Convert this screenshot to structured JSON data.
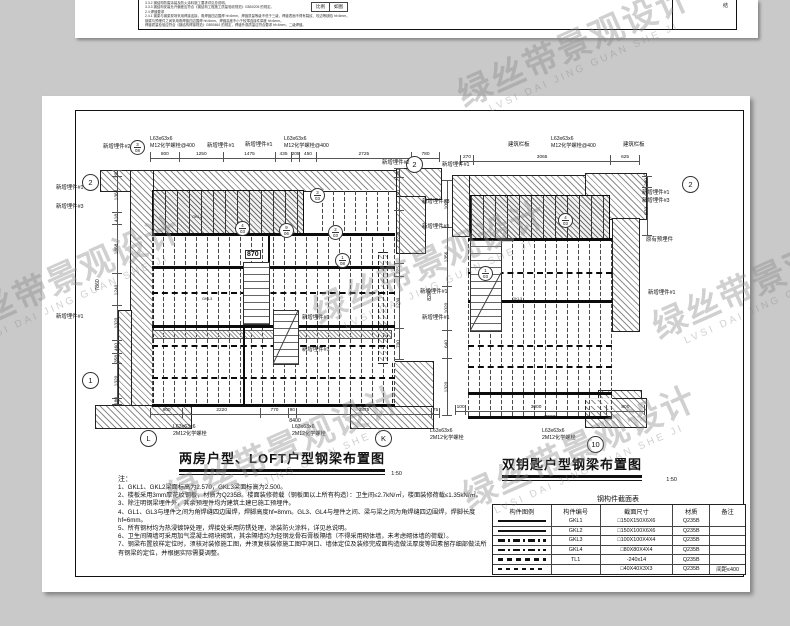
{
  "watermark": {
    "cn": "绿丝带景观设计",
    "en": "LVSI DAI JING GUAN SHE JI"
  },
  "top_sheet": {
    "lines": [
      "3.3.2 钢结构防腐涂装及防火涂料施工要求详见总说明。",
      "3.3.3 钢结构安装允许偏差应符合《钢结构工程施工质量验收规范》GB50205 的规定。",
      "2.4 焊缝要求",
      "2.4.1 钢梁与钢梁现场采用焊接连接，角焊缝四边围焊 hf=6mm，焊缝质量等级不低于三级，焊缝表面不得有裂纹、咬边等缺陷 hf=6mm。",
      "钢梁与预埋件之间采用角焊缝四边围焊 hf=6mm，焊缝高度不小于较薄连接件厚度 hf=6mm。",
      "焊缝质量检验应符合《钢结构焊接规范》GB50661 的规定，焊缝外观质量应符合要求 hf=6mm，二级焊缝。"
    ],
    "scale_label": "比例",
    "scale_value": "如图",
    "corner_mark": "结"
  },
  "plans": {
    "left": {
      "title": "两房户型、LOFT户型钢梁布置图",
      "scale": "1:50",
      "dims_top": [
        "800",
        "1250",
        "1475",
        "435",
        "205",
        "450",
        "2725",
        "780"
      ],
      "dims_bottom": [
        "900",
        "2220",
        "770",
        "90",
        "3875",
        "75"
      ],
      "total_bottom": "8400",
      "dims_left": [
        "200",
        "1368",
        "418",
        "1868",
        "1240",
        "1320",
        "460",
        "358",
        "1320",
        "180"
      ],
      "total_left": "7860",
      "dims_right": [
        "200",
        "750",
        "1229",
        "275",
        "1230",
        "700"
      ],
      "stair_width": "870"
    },
    "right": {
      "title": "双钥匙户型钢梁布置图",
      "scale": "1:50",
      "dims_top": [
        "270",
        "3065",
        "625"
      ],
      "dims_bottom": [
        "100",
        "3000",
        "800"
      ],
      "total_bottom": "3900",
      "dims_left": [
        "1090",
        "1356",
        "1020",
        "640",
        "1320"
      ],
      "total_left": "8200",
      "dims_right": [
        "200",
        "970"
      ]
    }
  },
  "labels": {
    "new_embed_1": "新增埋件#1",
    "new_embed_2": "新增埋件#2",
    "new_embed_3": "新增埋件#3",
    "orig_embed": "原有预埋件",
    "rail": "建筑栏板",
    "angle": "L63x63x6",
    "bolt400": "M12化学螺栓@400",
    "bolt2": "2M12化学螺栓"
  },
  "axes": {
    "two": "2",
    "one": "1",
    "L": "L",
    "K": "K",
    "ten": "10"
  },
  "details": {
    "d1n": "3",
    "d1s": "08",
    "d2n": "3",
    "d2s": "03",
    "d3n": "4",
    "d3s": "03",
    "d4n": "9",
    "d4s": "06",
    "d5n": "2",
    "d5s": "03",
    "d6n": "1",
    "d6s": "08",
    "d7n": "4",
    "d7s": "03",
    "d8n": "1",
    "d8s": "03"
  },
  "beam_tags": {
    "g2": "GKL2",
    "g3": "GKL3"
  },
  "notes": {
    "label": "注：",
    "lines": [
      "1、GKL1、GKL2梁面标高为2.570，GKL3梁面标高为2.500。",
      "2、楼板采用3mm厚花纹钢板，材质为Q235B。楼面装修荷载（钢板面以上所有构造）：卫生间≤2.7kN/㎡，楼面装修荷载≤1.35kN/㎡。",
      "3、除注明钢梁埋件外，其余预埋件均为建筑土建已施工预埋件。",
      "4、GL1、GL3与埋件之间为角焊缝四边围焊，焊脚高度hf=8mm。GL3、GL4与埋件之间、梁与梁之间为角焊缝四边围焊，焊脚长度hf=6mm。",
      "5、所有钢材均为热浸镀锌处理，焊接处采用防锈处理，涂装防火涂料，详见总说明。",
      "6、卫生间隔墙可采用加气混凝土砌块砌筑，其余隔墙均为轻钢龙骨石膏板隔墙（不得采用砌体墙，未考虑砌体墙的荷载）。",
      "7、钢梁布置放样定位时，须核对装修施工图，并须复核装修施工图中洞口、墙体定位及装修完成面构造做法厚度等因素留存细部做法所有钢梁的定位，并根据实际需要调整。"
    ]
  },
  "table": {
    "title": "钢构件截面表",
    "headers": [
      "构件图例",
      "构件编号",
      "截面尺寸",
      "材质",
      "备注"
    ],
    "rows": [
      {
        "legend": "solid",
        "no": "GKL1",
        "size": "□150X150X6X6",
        "mat": "Q235B",
        "note": ""
      },
      {
        "legend": "solid",
        "no": "GKL2",
        "size": "□150X100X6X6",
        "mat": "Q235B",
        "note": ""
      },
      {
        "legend": "dashdot",
        "no": "GKL3",
        "size": "□100X100X4X4",
        "mat": "Q235B",
        "note": ""
      },
      {
        "legend": "dashdot",
        "no": "GKL4",
        "size": "□80X80X4X4",
        "mat": "Q235B",
        "note": ""
      },
      {
        "legend": "dash",
        "no": "TL1",
        "size": "-240x14",
        "mat": "Q235B",
        "note": ""
      },
      {
        "legend": "dash2",
        "no": "",
        "size": "□40X40X3X3",
        "mat": "Q235B",
        "note": "间距≤400"
      }
    ]
  }
}
